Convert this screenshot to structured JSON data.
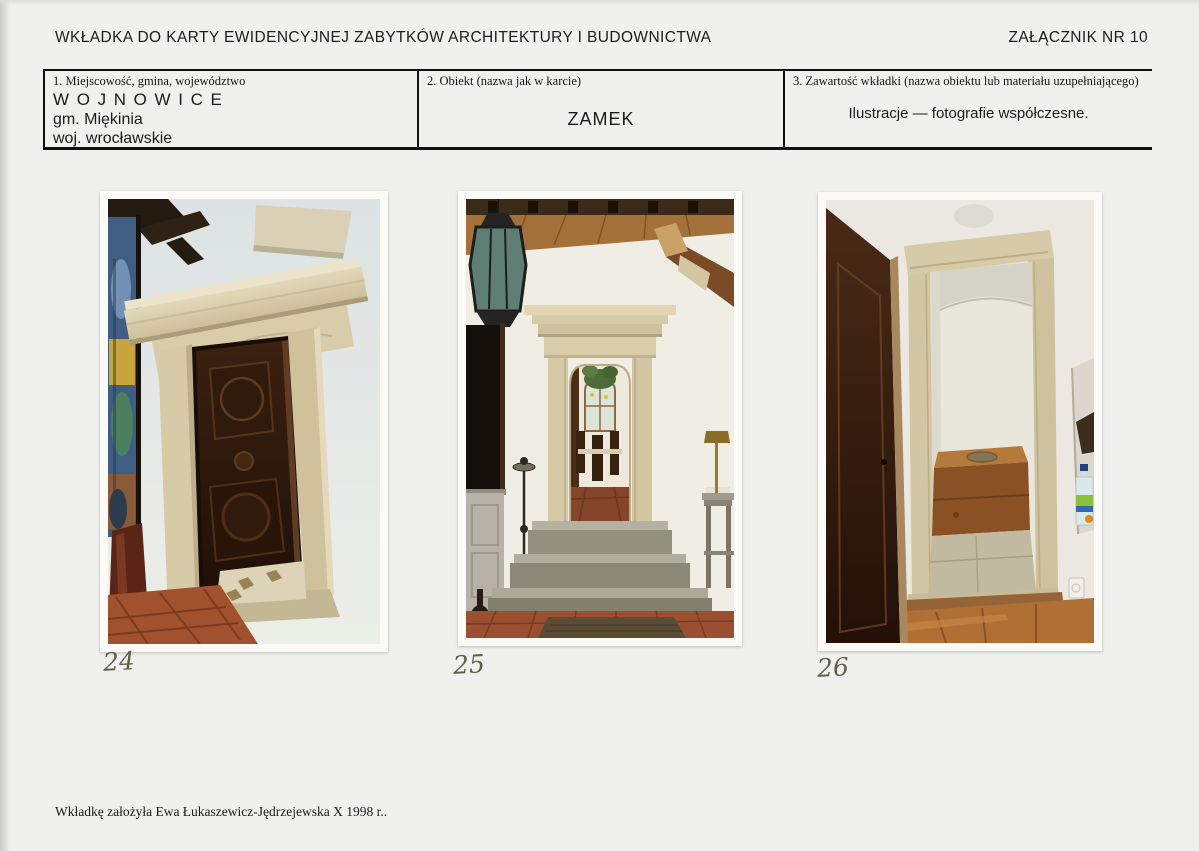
{
  "header": {
    "title": "WKŁADKA DO KARTY EWIDENCYJNEJ ZABYTKÓW ARCHITEKTURY I BUDOWNICTWA",
    "attachment": "ZAŁĄCZNIK NR 10"
  },
  "form": {
    "fields": [
      {
        "label": "1. Miejscowość, gmina, województwo",
        "lines": [
          "WOJNOWICE",
          "gm. Miękinia",
          "woj. wrocławskie"
        ]
      },
      {
        "label": "2. Obiekt (nazwa jak w karcie)",
        "value": "ZAMEK"
      },
      {
        "label": "3. Zawartość wkładki (nazwa obiektu lub materiału uzupełniającego)",
        "value": "Ilustracje — fotografie współczesne."
      }
    ]
  },
  "photos": [
    {
      "number": "24",
      "description": "Renaissance stone door portal with carved dark wooden door, terracotta floor"
    },
    {
      "number": "25",
      "description": "Hallway with beamed ceiling, lantern, stone portal and three steps into dining room"
    },
    {
      "number": "26",
      "description": "Stone-framed wall niche with wooden seat box, open dark door at left"
    }
  ],
  "footer": {
    "note": "Wkładkę założyła Ewa Łukaszewicz-Jędrzejewska X 1998 r.."
  },
  "colors": {
    "paper": "#f0f0ee",
    "ink": "#1c1c1c",
    "handwriting": "#5f5f4a",
    "stone": "#d6c9a6",
    "dark_wood": "#2f1a0c",
    "terracotta": "#9e5030"
  }
}
